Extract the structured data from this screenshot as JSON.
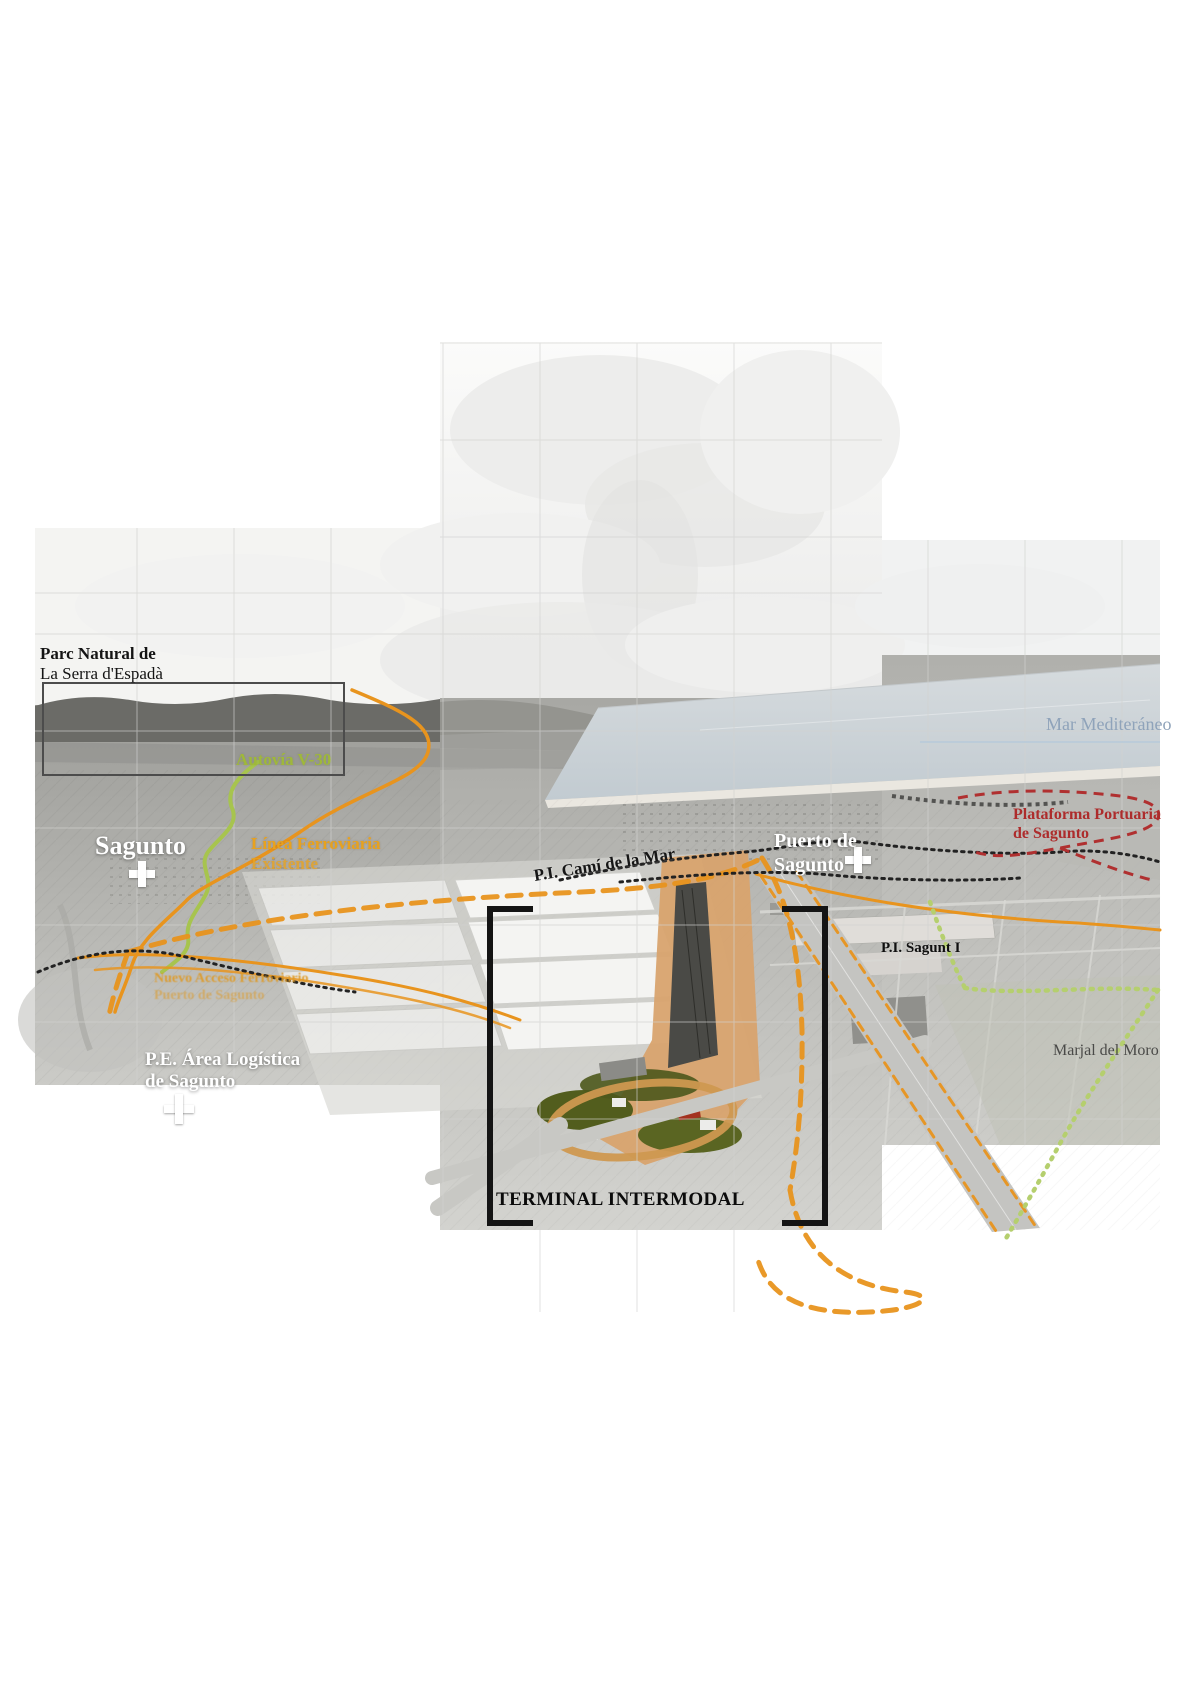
{
  "map": {
    "labels": {
      "parc_natural_line1": "Parc Natural de",
      "parc_natural_line2": "La Serra d'Espadà",
      "autovia": "Autovía V-30",
      "sagunto": "Sagunto",
      "linea_ferroviaria_line1": "Línea Ferroviaria",
      "linea_ferroviaria_line2": "Existente",
      "nuevo_acceso_line1": "Nuevo Acceso Ferroviario",
      "nuevo_acceso_line2": "Puerto de Sagunto",
      "pi_cami_de_la_mar": "P.I. Camí de la Mar",
      "puerto_line1": "Puerto de",
      "puerto_line2": "Sagunto",
      "mar_mediterraneo": "Mar Mediteráneo",
      "plataforma_line1": "Plataforma Portuaria",
      "plataforma_line2": "de Sagunto",
      "pi_sagunt": "P.I. Sagunt I",
      "marjal_del_moro": "Marjal del Moro",
      "pe_area_line1": "P.E. Área Logística",
      "pe_area_line2": "de Sagunto",
      "terminal_intermodal": "TERMINAL INTERMODAL"
    },
    "line_colors": {
      "autovia_green": "#9fb83a",
      "rail_orange_solid": "#e8941e",
      "new_access_orange_dashed": "#e8941e",
      "port_red_dashed": "#b03030",
      "marjal_green_dotted": "#b5cf6e",
      "existing_road_black_dotted": "#222222",
      "sea_label_blue": "#8fa3ba"
    },
    "markers": {
      "sagunto_cross": "white-cross",
      "puerto_sagunto_cross": "white-cross",
      "pe_area_cross": "white-cross"
    }
  }
}
